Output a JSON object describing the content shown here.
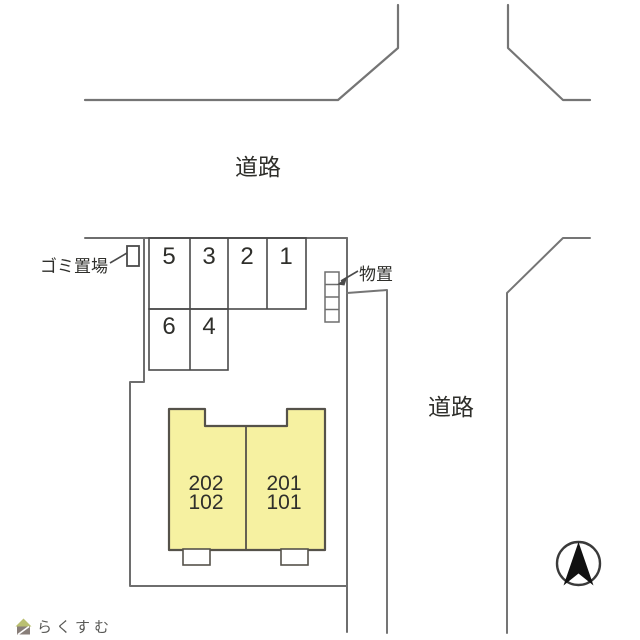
{
  "canvas": {
    "width": 640,
    "height": 640,
    "background": "#ffffff"
  },
  "colors": {
    "road_line": "#757575",
    "boundary_line": "#6e6e6e",
    "grid_line": "#4a4a4a",
    "building_fill": "#f6f1a1",
    "building_outline": "#55524a",
    "text_dark": "#2f2f2b",
    "compass_arrow": "#111111",
    "watermark_text": "#b6aea7",
    "watermark_roof": "#aab04e",
    "watermark_body": "#6b5f58"
  },
  "labels": {
    "road_top": "道路",
    "road_right": "道路",
    "garbage_area": "ゴミ置場",
    "storage": "物置"
  },
  "parking": {
    "row1": [
      "5",
      "3",
      "2",
      "1"
    ],
    "row2": [
      "6",
      "4"
    ]
  },
  "building": {
    "left_unit_upper": "202",
    "left_unit_lower": "102",
    "right_unit_upper": "201",
    "right_unit_lower": "101"
  },
  "watermark": {
    "brand": "らくすむ"
  },
  "icons": {
    "compass": "north-arrow-icon",
    "logo": "house-logo-icon"
  }
}
